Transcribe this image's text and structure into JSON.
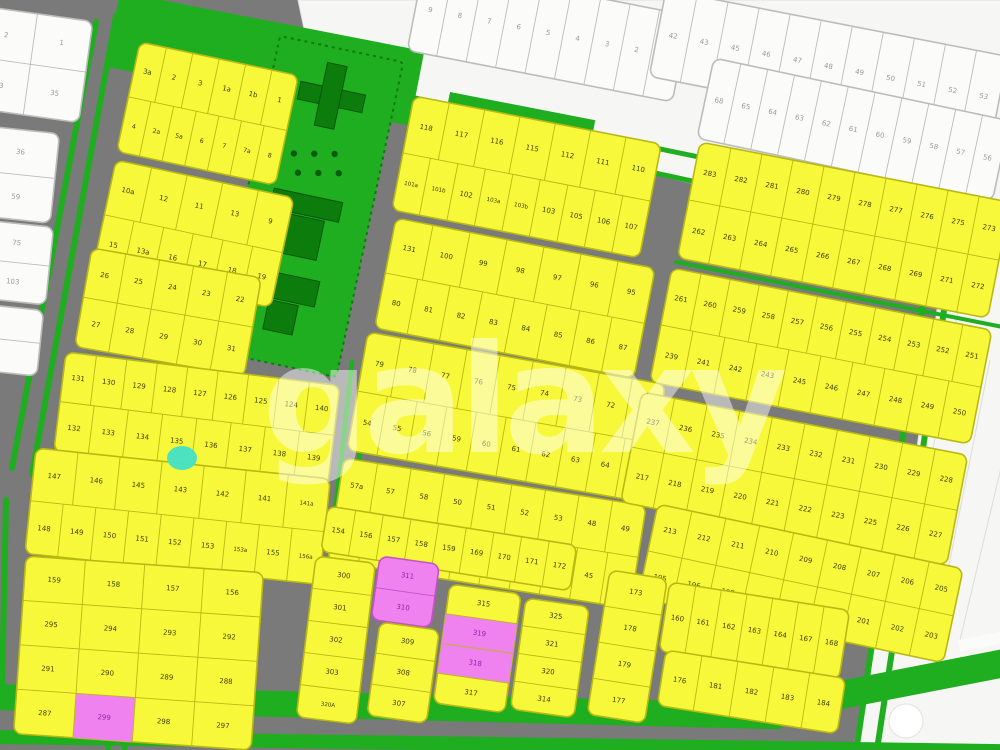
{
  "watermark": {
    "text": "galaxy",
    "color": "#ffffff",
    "opacity": 0.48
  },
  "map": {
    "colors": {
      "road": "#7a7a7a",
      "yellow": "#f8f83b",
      "yellow_stroke": "#b9b913",
      "yellow_text": "#3f3f05",
      "white": "#fbfbf9",
      "white_stroke": "#bcbcbc",
      "white_text": "#9a9a9a",
      "white_area": "#f6f6f4",
      "green": "#1fae1f",
      "dark_green": "#0c7c0c",
      "pink": "#ef82ee",
      "pink_text": "#8e24aa",
      "teal": "#43e0c6",
      "roundabout": "#ffffff"
    },
    "white_areas": [
      "298,0 1012,0 1012,258 318,96",
      "944,262 1012,246 1012,758 852,758 874,636 914,468"
    ],
    "white_area_lines": [
      [
        960,
        300,
        920,
        520
      ],
      [
        990,
        360,
        942,
        600
      ],
      [
        1010,
        430,
        960,
        640
      ]
    ],
    "white_bars": [
      [
        958,
        640,
        52,
        12,
        -11
      ]
    ],
    "green_rects": [
      [
        120,
        -8,
        310,
        76,
        11
      ],
      [
        186,
        58,
        96,
        64,
        10
      ],
      [
        450,
        92,
        148,
        40,
        11
      ],
      [
        -8,
        684,
        790,
        26,
        1.4
      ],
      [
        -8,
        730,
        1020,
        14,
        0.8
      ],
      [
        772,
        694,
        248,
        28,
        -11
      ]
    ],
    "green_lines": [
      [
        96,
        22,
        12,
        468,
        6
      ],
      [
        116,
        16,
        32,
        474,
        6
      ],
      [
        405,
        96,
        1012,
        222,
        5
      ],
      [
        428,
        124,
        1012,
        250,
        5
      ],
      [
        676,
        262,
        1008,
        328,
        4
      ],
      [
        928,
        268,
        856,
        752,
        6
      ],
      [
        948,
        284,
        876,
        756,
        6
      ],
      [
        352,
        362,
        330,
        560,
        5
      ],
      [
        370,
        364,
        348,
        562,
        5
      ],
      [
        118,
        650,
        108,
        752,
        5
      ],
      [
        134,
        652,
        124,
        754,
        5
      ],
      [
        6,
        500,
        2,
        690,
        6
      ]
    ],
    "park": {
      "x": 280,
      "y": 36,
      "w": 126,
      "h": 322,
      "angle": 12,
      "buildings": [
        [
          30,
          40,
          66,
          18
        ],
        [
          52,
          16,
          20,
          64
        ],
        [
          26,
          150,
          70,
          20
        ],
        [
          36,
          172,
          46,
          40
        ],
        [
          30,
          232,
          60,
          26
        ],
        [
          44,
          260,
          30,
          30
        ]
      ],
      "dots": [
        [
          38,
          112
        ],
        [
          58,
          108
        ],
        [
          78,
          104
        ],
        [
          46,
          130
        ],
        [
          66,
          126
        ],
        [
          86,
          122
        ]
      ]
    },
    "teal_marker": {
      "cx": 182,
      "cy": 458,
      "rx": 15,
      "ry": 12
    },
    "roundabout": {
      "cx": 906,
      "cy": 721,
      "r": 17
    },
    "blocks": [
      {
        "n": "white-top-left",
        "f": "w",
        "x": -18,
        "y": 6,
        "w": 112,
        "h": 102,
        "a": 8,
        "rows": [
          [
            "2",
            "1"
          ],
          [
            "33",
            "35"
          ]
        ]
      },
      {
        "n": "white-left-1",
        "f": "w",
        "x": -14,
        "y": 126,
        "w": 74,
        "h": 90,
        "a": 6,
        "rows": [
          [
            "36"
          ],
          [
            "59"
          ]
        ]
      },
      {
        "n": "white-left-2",
        "f": "w",
        "x": -16,
        "y": 220,
        "w": 70,
        "h": 78,
        "a": 6,
        "rows": [
          [
            "75"
          ],
          [
            "103"
          ]
        ]
      },
      {
        "n": "white-left-3",
        "f": "w",
        "x": -18,
        "y": 304,
        "w": 62,
        "h": 66,
        "a": 6,
        "rows": [
          [
            ""
          ],
          [
            ""
          ]
        ]
      },
      {
        "n": "white-top-strip-1",
        "f": "w",
        "x": 424,
        "y": -36,
        "w": 270,
        "h": 88,
        "a": 11,
        "rows": [
          [
            "9",
            "8",
            "7",
            "6",
            "5",
            "4",
            "3",
            "2",
            "1"
          ]
        ]
      },
      {
        "n": "white-top-strip-2",
        "f": "w",
        "x": 666,
        "y": -10,
        "w": 348,
        "h": 88,
        "a": 11,
        "rows": [
          [
            "42",
            "43",
            "45",
            "46",
            "47",
            "48",
            "49",
            "50",
            "51",
            "52",
            "53"
          ]
        ]
      },
      {
        "n": "white-top-strip-3",
        "f": "w",
        "x": 714,
        "y": 58,
        "w": 302,
        "h": 82,
        "a": 12,
        "rows": [
          [
            "68",
            "65",
            "64",
            "63",
            "62",
            "61",
            "60",
            "59",
            "58",
            "57",
            "56"
          ]
        ]
      },
      {
        "n": "block-1",
        "f": "y",
        "x": 140,
        "y": 42,
        "w": 162,
        "h": 112,
        "a": 12,
        "rows": [
          [
            "3a",
            "2",
            "3",
            "1a",
            "1b",
            "1"
          ],
          [
            "4",
            "2a",
            "5a",
            "6",
            "7",
            "7a",
            "8"
          ]
        ]
      },
      {
        "n": "block-2",
        "f": "y",
        "x": 116,
        "y": 160,
        "w": 182,
        "h": 112,
        "a": 12,
        "rows": [
          [
            "10a",
            "12",
            "11",
            "13",
            "9"
          ],
          [
            "15",
            "13a",
            "16",
            "17",
            "18",
            "19"
          ]
        ]
      },
      {
        "n": "block-3",
        "f": "y",
        "x": 92,
        "y": 248,
        "w": 172,
        "h": 100,
        "a": 10,
        "rows": [
          [
            "26",
            "25",
            "24",
            "23",
            "22"
          ],
          [
            "27",
            "28",
            "29",
            "30",
            "31"
          ]
        ]
      },
      {
        "n": "block-4",
        "f": "y",
        "x": 66,
        "y": 352,
        "w": 276,
        "h": 100,
        "a": 7,
        "rows": [
          [
            "131",
            "130",
            "129",
            "128",
            "127",
            "126",
            "125",
            "124",
            "140"
          ],
          [
            "132",
            "133",
            "134",
            "135",
            "136",
            "137",
            "138",
            "139"
          ]
        ]
      },
      {
        "n": "block-5",
        "f": "y",
        "x": 36,
        "y": 448,
        "w": 296,
        "h": 106,
        "a": 6,
        "rows": [
          [
            "147",
            "146",
            "145",
            "143",
            "142",
            "141",
            "141a"
          ],
          [
            "148",
            "149",
            "150",
            "151",
            "152",
            "153",
            "153a",
            "155",
            "156a"
          ]
        ]
      },
      {
        "n": "block-6",
        "f": "y",
        "x": 26,
        "y": 556,
        "w": 238,
        "h": 178,
        "a": 4,
        "rows": [
          [
            "159",
            "158",
            "157",
            "156"
          ],
          [
            "295",
            "294",
            "293",
            "292"
          ],
          [
            "291",
            "290",
            "289",
            "288"
          ],
          [
            "287",
            {
              "t": "299",
              "c": "p"
            },
            "298",
            "297"
          ]
        ]
      },
      {
        "n": "block-m1",
        "f": "y",
        "x": 414,
        "y": 96,
        "w": 252,
        "h": 116,
        "a": 11,
        "rows": [
          [
            "118",
            "117",
            "116",
            "115",
            "112",
            "111",
            "110"
          ],
          [
            "101a",
            "101b",
            "102",
            "103a",
            "103b",
            "103",
            "105",
            "106",
            "107"
          ]
        ]
      },
      {
        "n": "block-m2",
        "f": "y",
        "x": 396,
        "y": 218,
        "w": 264,
        "h": 112,
        "a": 11,
        "rows": [
          [
            "131",
            "100",
            "99",
            "98",
            "97",
            "96",
            "95"
          ],
          [
            "80",
            "81",
            "82",
            "83",
            "84",
            "85",
            "86",
            "87"
          ]
        ]
      },
      {
        "n": "block-m3",
        "f": "y",
        "x": 368,
        "y": 332,
        "w": 302,
        "h": 120,
        "a": 10,
        "rows": [
          [
            "79",
            "78",
            "77",
            "76",
            "75",
            "74",
            "73",
            "72",
            "71"
          ],
          [
            "54",
            "55",
            "56",
            "59",
            "60",
            "61",
            "62",
            "63",
            "64",
            "66"
          ]
        ]
      },
      {
        "n": "block-m4",
        "f": "y",
        "x": 344,
        "y": 458,
        "w": 306,
        "h": 104,
        "a": 9,
        "rows": [
          [
            "57a",
            "57",
            "58",
            "50",
            "51",
            "52",
            "53",
            "48",
            "49"
          ],
          [
            "35",
            "36",
            "37",
            "38",
            "39",
            "41",
            "42",
            "43",
            "45",
            "46"
          ]
        ]
      },
      {
        "n": "block-r1",
        "f": "y",
        "x": 700,
        "y": 142,
        "w": 316,
        "h": 118,
        "a": 11,
        "rows": [
          [
            "283",
            "282",
            "281",
            "280",
            "279",
            "278",
            "277",
            "276",
            "275",
            "273"
          ],
          [
            "262",
            "263",
            "264",
            "265",
            "266",
            "267",
            "268",
            "269",
            "271",
            "272"
          ]
        ]
      },
      {
        "n": "block-r2",
        "f": "y",
        "x": 672,
        "y": 268,
        "w": 326,
        "h": 116,
        "a": 11,
        "rows": [
          [
            "261",
            "260",
            "259",
            "258",
            "257",
            "256",
            "255",
            "254",
            "253",
            "252",
            "251"
          ],
          [
            "239",
            "241",
            "242",
            "243",
            "245",
            "246",
            "247",
            "248",
            "249",
            "250"
          ]
        ]
      },
      {
        "n": "block-r3",
        "f": "y",
        "x": 642,
        "y": 392,
        "w": 332,
        "h": 112,
        "a": 11,
        "rows": [
          [
            "237",
            "236",
            "235",
            "234",
            "233",
            "232",
            "231",
            "230",
            "229",
            "228"
          ],
          [
            "217",
            "218",
            "219",
            "220",
            "221",
            "222",
            "223",
            "225",
            "226",
            "227"
          ]
        ]
      },
      {
        "n": "block-r4",
        "f": "y",
        "x": 658,
        "y": 504,
        "w": 312,
        "h": 96,
        "a": 12,
        "rows": [
          [
            "213",
            "212",
            "211",
            "210",
            "209",
            "208",
            "207",
            "206",
            "205"
          ],
          [
            "195",
            "196",
            "197",
            "198",
            "199",
            "200",
            "201",
            "202",
            "203"
          ]
        ]
      },
      {
        "n": "block-b8-left",
        "f": "y",
        "x": 610,
        "y": 570,
        "w": 58,
        "h": 146,
        "a": 9,
        "rows": [
          [
            "173"
          ],
          [
            "178"
          ],
          [
            "179"
          ],
          [
            "177"
          ]
        ]
      },
      {
        "n": "block-b8-top",
        "f": "y",
        "x": 670,
        "y": 582,
        "w": 182,
        "h": 70,
        "a": 9,
        "rows": [
          [
            "160",
            "161",
            "162",
            "163",
            "164",
            "167",
            "168"
          ]
        ]
      },
      {
        "n": "block-b8-bottom",
        "f": "y",
        "x": 666,
        "y": 650,
        "w": 182,
        "h": 56,
        "a": 9,
        "rows": [
          [
            "176",
            "181",
            "182",
            "183",
            "184"
          ]
        ]
      },
      {
        "n": "block-b7-top",
        "f": "y",
        "x": 328,
        "y": 506,
        "w": 252,
        "h": 46,
        "a": 9,
        "rows": [
          [
            "154",
            "156",
            "157",
            "158",
            "159",
            "169",
            "170",
            "171",
            "172"
          ]
        ]
      },
      {
        "n": "block-b7-leftcol",
        "f": "y",
        "x": 316,
        "y": 556,
        "w": 60,
        "h": 162,
        "a": 7,
        "rows": [
          [
            "300"
          ],
          [
            "301"
          ],
          [
            "302"
          ],
          [
            "303"
          ],
          [
            "320A"
          ]
        ]
      },
      {
        "n": "block-b7-pink-a",
        "f": "p",
        "x": 380,
        "y": 556,
        "w": 60,
        "h": 64,
        "a": 8,
        "rows": [
          [
            "311"
          ],
          [
            "310"
          ]
        ]
      },
      {
        "n": "block-b7-midcol",
        "f": "y",
        "x": 380,
        "y": 622,
        "w": 60,
        "h": 94,
        "a": 8,
        "rows": [
          [
            "309"
          ],
          [
            "308"
          ],
          [
            "307"
          ]
        ]
      },
      {
        "n": "block-b7-col2",
        "f": "y",
        "x": 450,
        "y": 584,
        "w": 72,
        "h": 120,
        "a": 8,
        "rows": [
          [
            "315"
          ],
          [
            {
              "t": "319",
              "c": "p"
            }
          ],
          [
            {
              "t": "318",
              "c": "p"
            }
          ],
          [
            "317"
          ]
        ]
      },
      {
        "n": "block-b7-col3",
        "f": "y",
        "x": 526,
        "y": 598,
        "w": 64,
        "h": 112,
        "a": 8,
        "rows": [
          [
            "325"
          ],
          [
            "321"
          ],
          [
            "320"
          ],
          [
            "314"
          ]
        ]
      }
    ]
  }
}
